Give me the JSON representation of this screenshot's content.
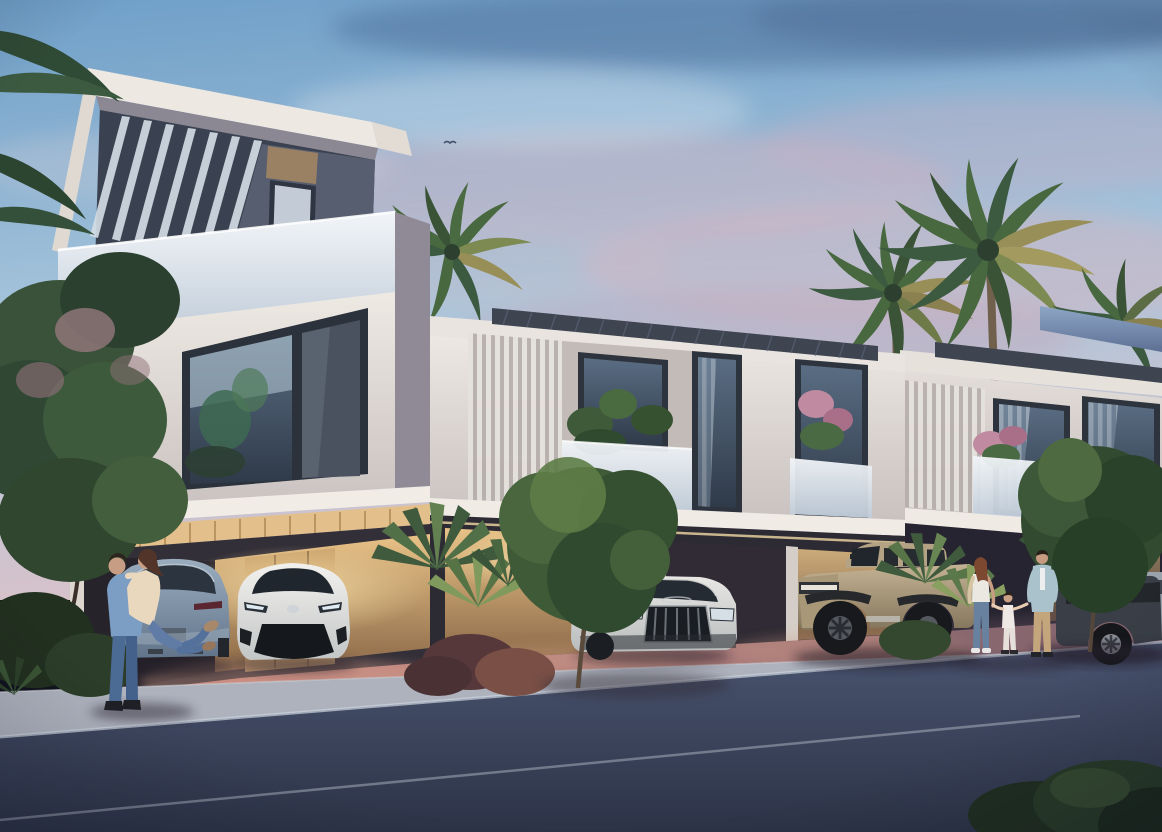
{
  "meta": {
    "type": "architectural-rendering",
    "title": "Modern townhouse community at dusk",
    "description": "Dusk 3D rendering of a modern white townhouse row with a three-storey corner villa, slatted roof pergolas, frosted glass balconies with plants, warm-lit covered carports holding a grey SUV, a white crossover, a white Audi-style SUV, a tan electric truck and a dark SUV, palm trees and shrubs, a couple embracing beside a car and a family of three walking on the pink paved driveway beside a street."
  },
  "scene": {
    "time_of_day": "dusk",
    "sky": {
      "top": "#6f9fc8",
      "mid": "#a9c6dc",
      "horizon": "#d8c2ca",
      "cloud_pink": "#d5b3c1",
      "cloud_dark": "#50719d"
    },
    "building": {
      "wall_light": "#eee9e3",
      "wall_shadow": "#c9c2c0",
      "panel_dark": "#575e6f",
      "panel_accent": "#9a8164",
      "glass": "#5a6d83",
      "glass_frosted": "#f2f5f8",
      "pergola": "#3e4550",
      "warm_light": "#e8c287",
      "teal_art": "#3f7e78"
    },
    "ground": {
      "driveway_left": "#c4837b",
      "driveway_right": "#8f6b72",
      "sidewalk": "#adb2bd",
      "road": "#4a5570",
      "road_deep": "#2c3347",
      "road_line": "#ccd4de"
    },
    "vehicles": [
      {
        "name": "grey-suv-rear",
        "color": "#9aadbf"
      },
      {
        "name": "white-crossover-front",
        "color": "#f2f1ee"
      },
      {
        "name": "white-audi-suv",
        "color": "#e9e8e5"
      },
      {
        "name": "tan-electric-truck",
        "color": "#c4b293"
      },
      {
        "name": "dark-suv",
        "color": "#3a3f47"
      },
      {
        "name": "silver-car-edge",
        "color": "#9aa2ac"
      }
    ],
    "vegetation": {
      "palm_dark": "#3c5a40",
      "palm_mid": "#48683f",
      "palm_light": "#7d9456",
      "palm_dry": "#988f58",
      "tree_dark": "#2f4733",
      "tree_mid": "#49663f",
      "blossom": "#9b7b82",
      "bush_red": "#7a5046"
    },
    "people": [
      {
        "name": "couple-embracing",
        "count": 2
      },
      {
        "name": "family-walking",
        "count": 3
      }
    ],
    "birds": 1
  }
}
